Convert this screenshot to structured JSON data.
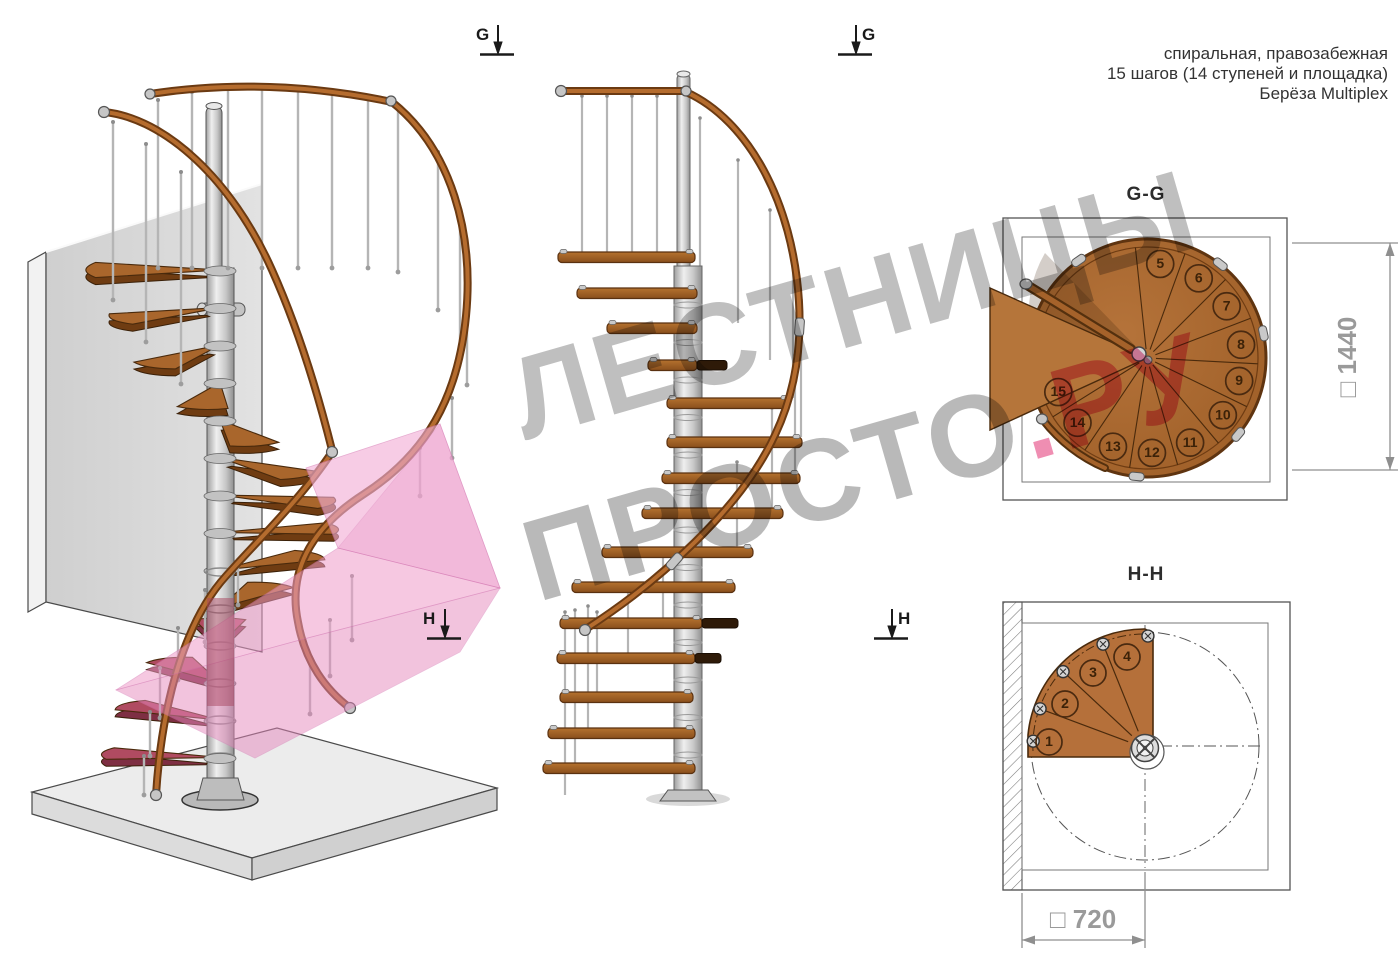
{
  "header": {
    "line1": "спиральная, правозабежная",
    "line2": "15 шагов (14 ступеней и площадка)",
    "line3": "Берёза Multiplex"
  },
  "watermark": {
    "line1": "ЛЕСТНИЦЫ",
    "line2_gray": "ПРОСТО",
    "line2_pink": ".РУ",
    "gray_color": "#8a8a8a",
    "pink_color": "#e4427f"
  },
  "markers": {
    "g": "G",
    "h": "H"
  },
  "views": {
    "view3d": {
      "name": "3d-render-spiral-staircase"
    },
    "elevation": {
      "name": "side-elevation-spiral-staircase"
    },
    "gg": {
      "title": "G-G",
      "steps": [
        5,
        6,
        7,
        8,
        9,
        10,
        11,
        12,
        13,
        14,
        15
      ],
      "dimension": {
        "symbol": "□",
        "value": "1440"
      }
    },
    "hh": {
      "title": "H-H",
      "steps": [
        1,
        2,
        3,
        4
      ],
      "dimension": {
        "symbol": "□",
        "value": "720"
      }
    }
  },
  "colors": {
    "wood": "#a9662c",
    "wood_light": "#b5753a",
    "wood_dark": "#5f3410",
    "handrail": "#a05a22",
    "metal": "#c9c9c9",
    "wall": "#d9d9d9",
    "floor": "#ebebeb",
    "pink_highlight": "#efa0cd",
    "crimson_step": "#b04b61",
    "dim_gray": "#9a9a9a"
  }
}
